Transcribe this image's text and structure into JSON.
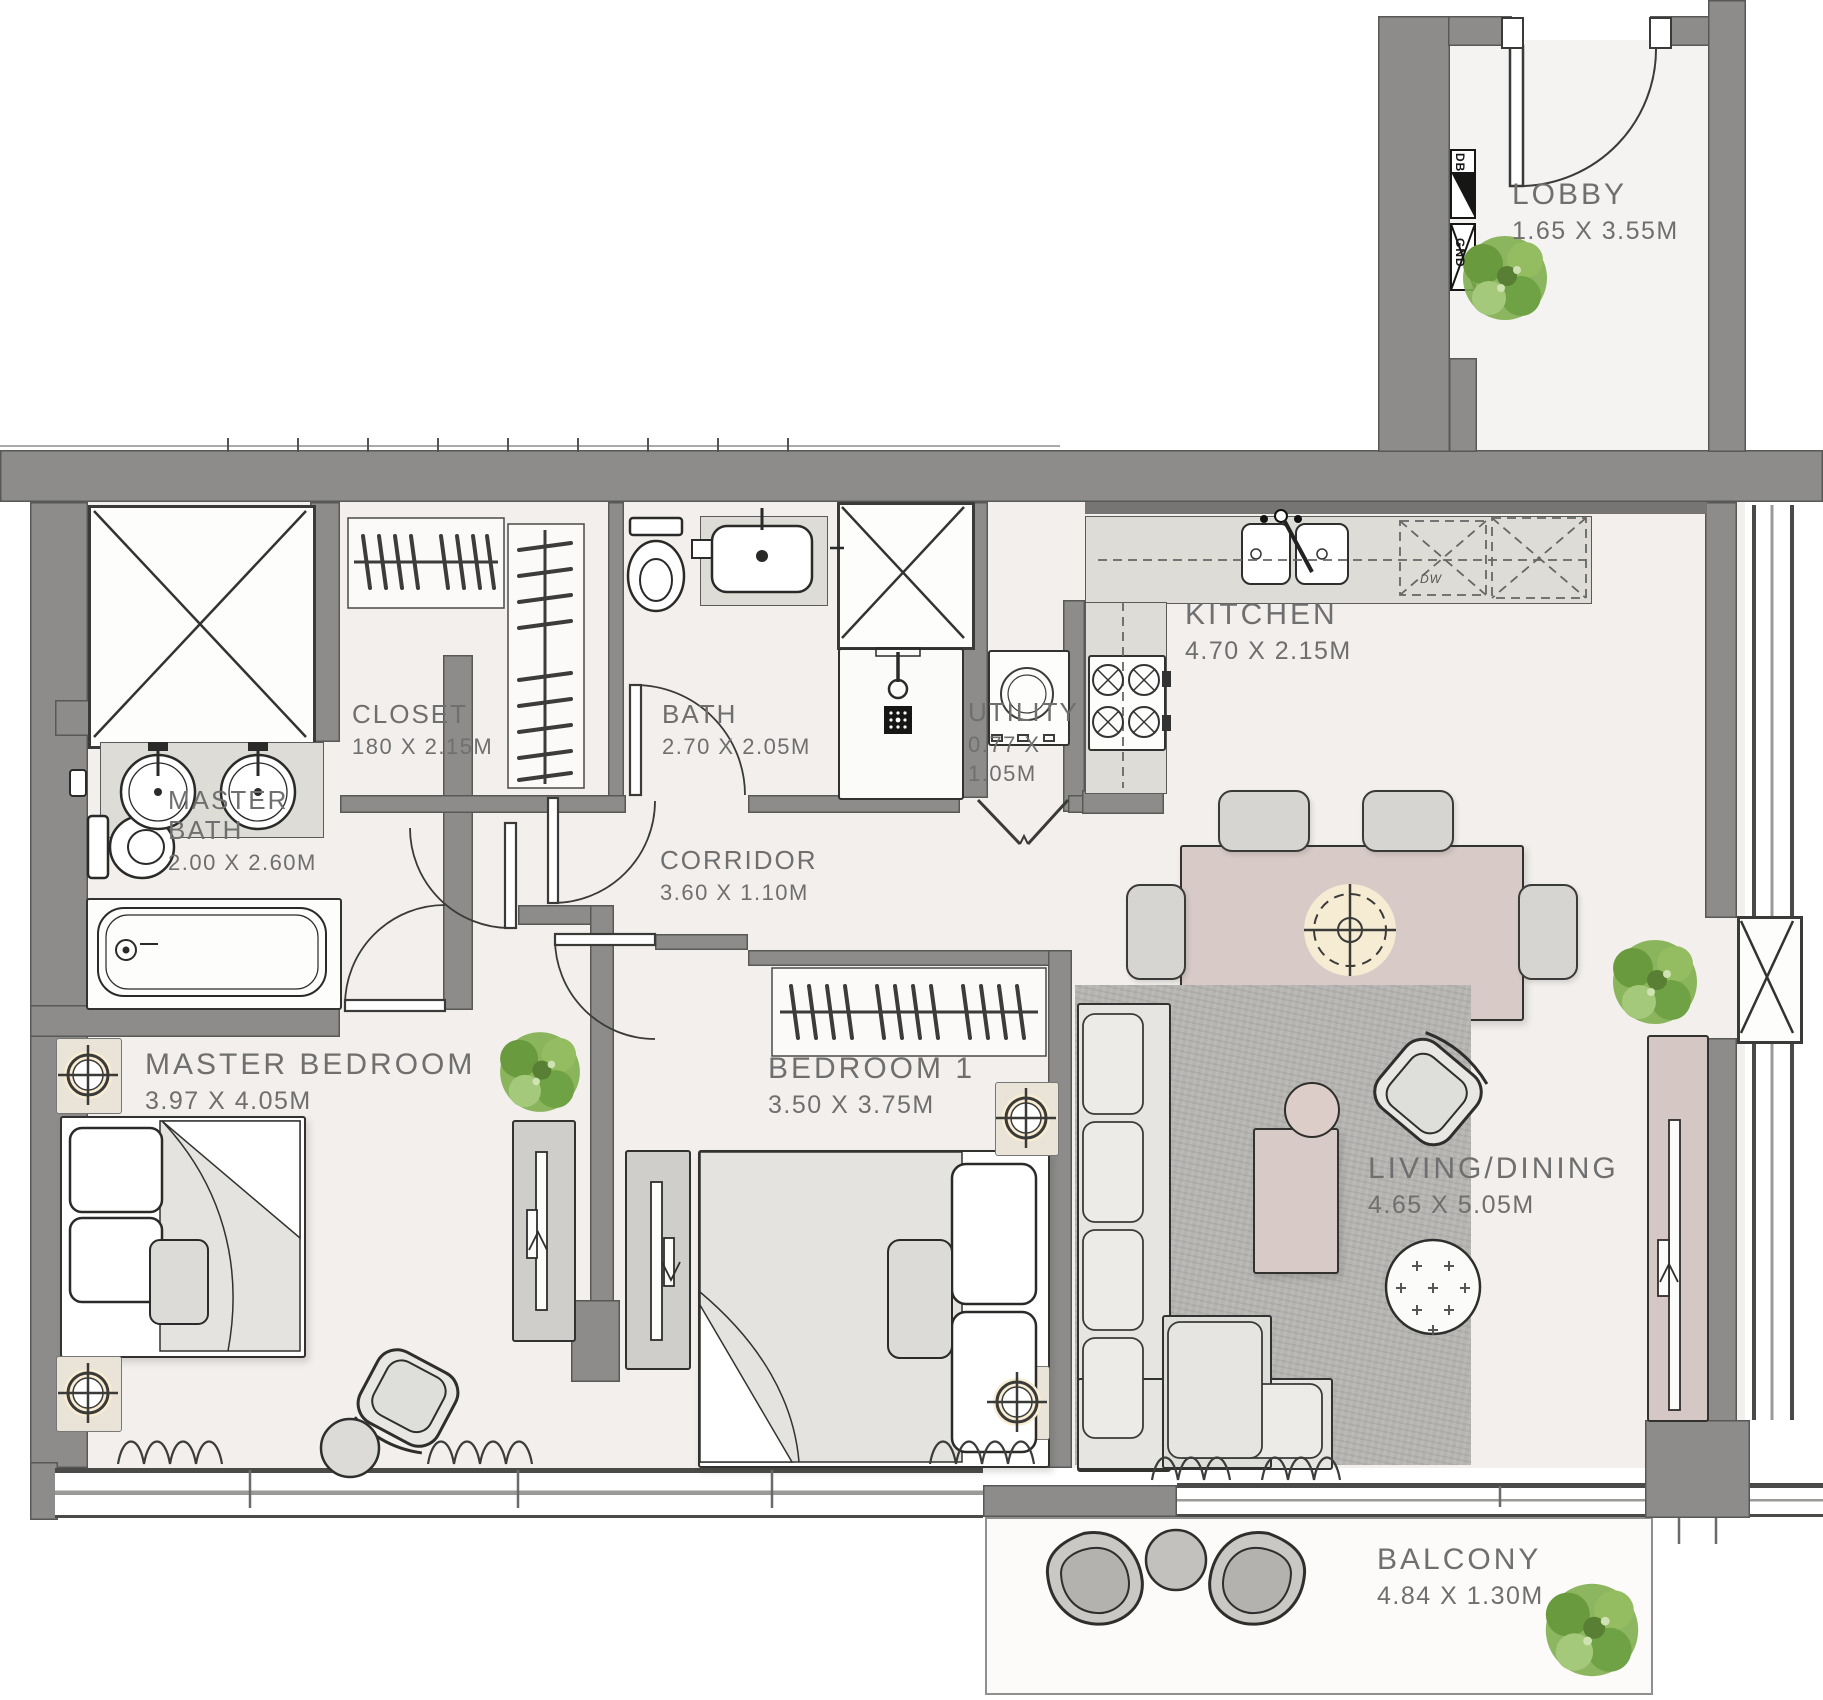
{
  "palette": {
    "wall": "#8d8c8a",
    "floor": "#f2efec",
    "label_text": "#6f6f6f",
    "accent_beige": "#d8cbc6",
    "rug_gray": "#b5b4b1",
    "plant_green": "#7fae4e"
  },
  "rooms": {
    "lobby": {
      "name": "LOBBY",
      "dims": "1.65 X 3.55M"
    },
    "kitchen": {
      "name": "KITCHEN",
      "dims": "4.70 X 2.15M"
    },
    "closet": {
      "name": "CLOSET",
      "dims": "180 X 2.15M"
    },
    "bath": {
      "name": "BATH",
      "dims": "2.70 X 2.05M"
    },
    "utility": {
      "name": "UTILITY",
      "dims_l1": "0.77 X",
      "dims_l2": "1.05M"
    },
    "master_bath": {
      "name_l1": "MASTER",
      "name_l2": "BATH",
      "dims": "2.00 X 2.60M"
    },
    "corridor": {
      "name": "CORRIDOR",
      "dims": "3.60 X 1.10M"
    },
    "master_bedroom": {
      "name": "MASTER BEDROOM",
      "dims": "3.97 X 4.05M"
    },
    "bedroom1": {
      "name": "BEDROOM 1",
      "dims": "3.50 X 3.75M"
    },
    "living_dining": {
      "name": "LIVING/DINING",
      "dims": "4.65 X 5.05M"
    },
    "balcony": {
      "name": "BALCONY",
      "dims": "4.84 X 1.30M"
    }
  },
  "equipment_tags": {
    "db": "DB",
    "gnd": "GND",
    "dw": "DW"
  }
}
